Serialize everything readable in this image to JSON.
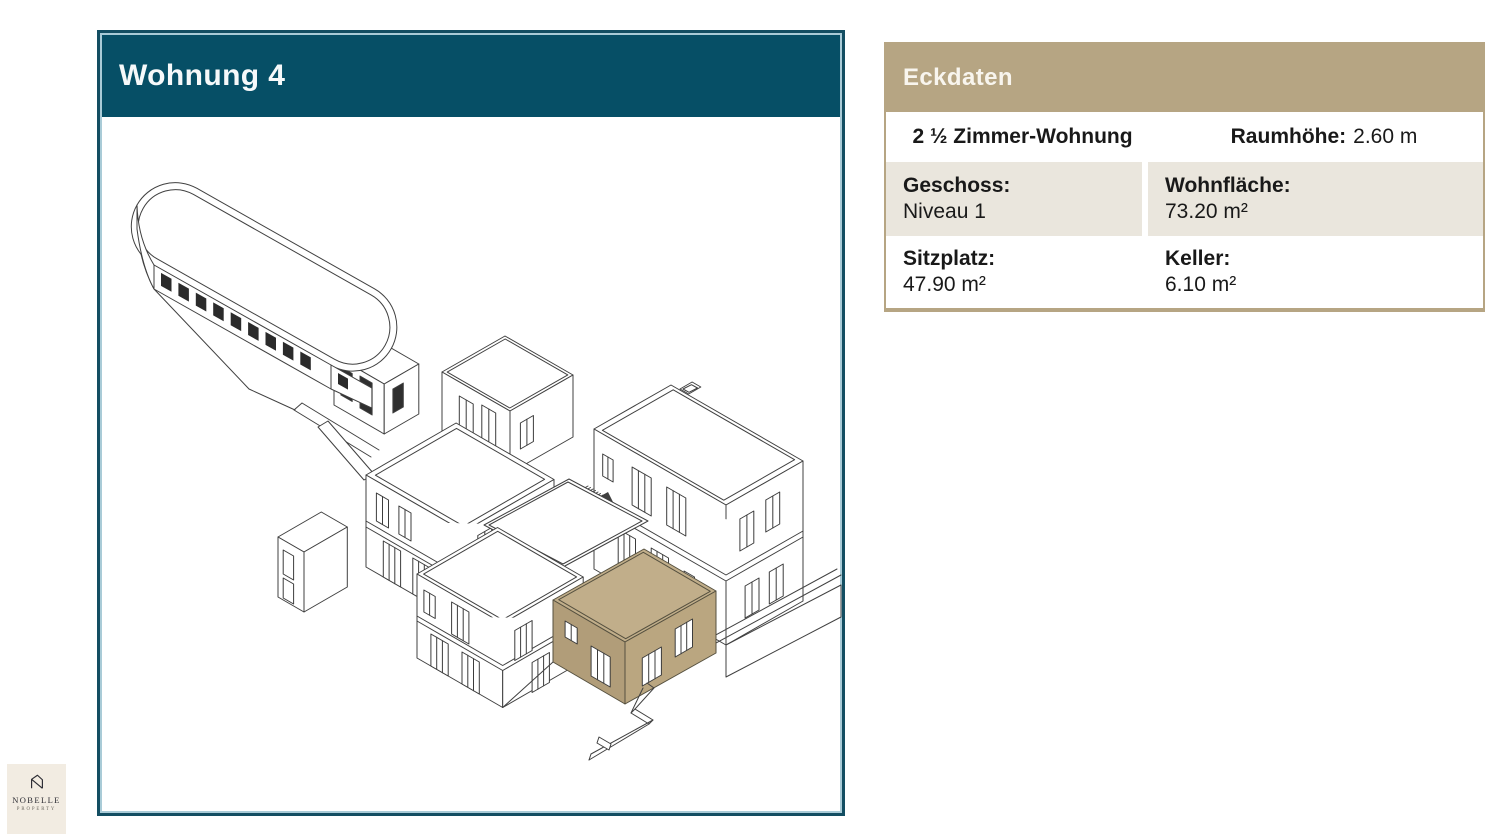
{
  "slide": {
    "title": "Wohnung 4"
  },
  "table": {
    "header": "Eckdaten",
    "rows": [
      {
        "left": {
          "label": "2 ½ Zimmer-Wohnung",
          "value": ""
        },
        "right": {
          "label": "Raumhöhe:",
          "value": "2.60 m"
        }
      },
      {
        "left": {
          "label": "Geschoss:",
          "value": "Niveau 1"
        },
        "right": {
          "label": "Wohnfläche:",
          "value": "73.20 m²"
        }
      },
      {
        "left": {
          "label": "Sitzplatz:",
          "value": "47.90 m²"
        },
        "right": {
          "label": "Keller:",
          "value": "6.10 m²"
        }
      }
    ]
  },
  "drawing": {
    "type": "axonometric-site-plan",
    "highlighted_unit": "Wohnung 4",
    "highlight_color": "#c1ae8a"
  },
  "logo": {
    "name": "NOBELLE",
    "sub": "PROPERTY"
  },
  "colors": {
    "teal_header": "#064f66",
    "panel_border": "#134e62",
    "tan_header": "#b6a583",
    "beige_row": "#eae6dd",
    "highlight_roof": "#c1ae8a",
    "highlight_wall_left": "#b19d79",
    "highlight_wall_right": "#baa680"
  }
}
